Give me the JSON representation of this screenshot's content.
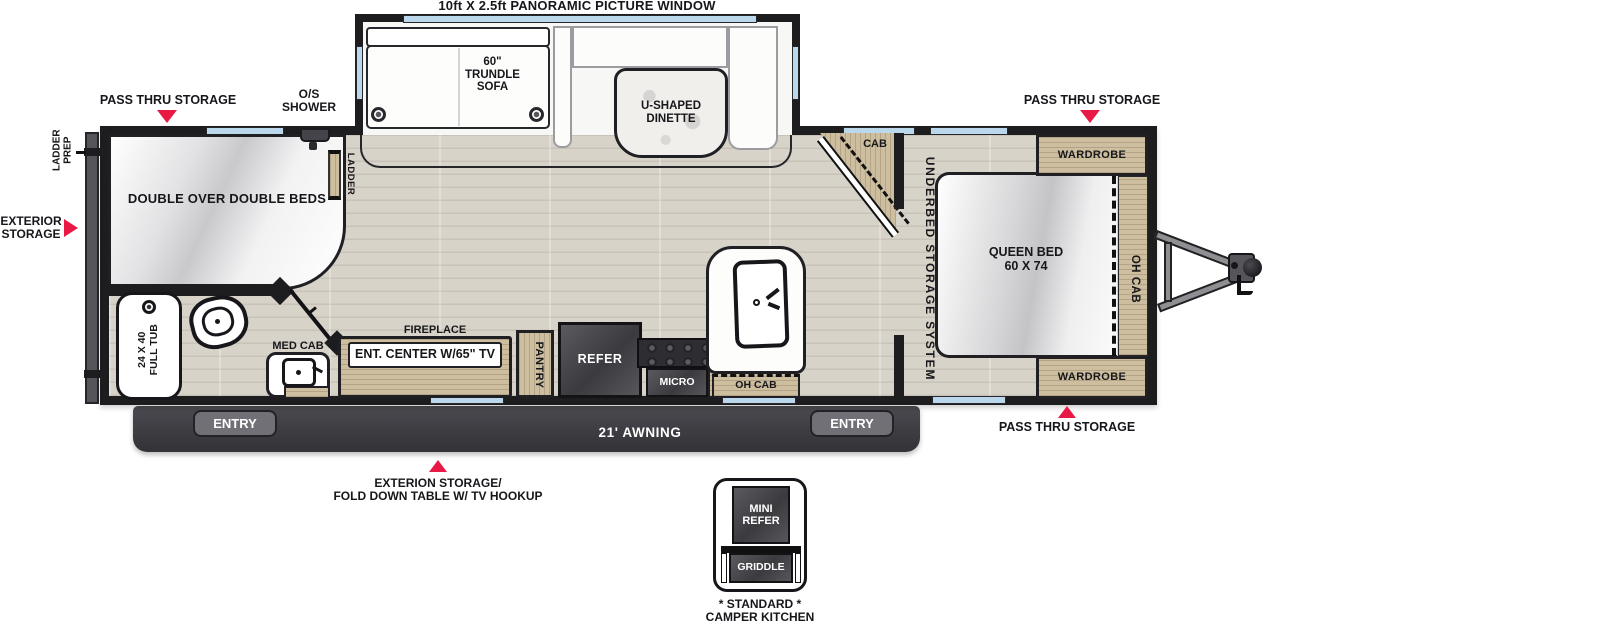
{
  "plan": {
    "title": "10ft X 2.5ft PANORAMIC PICTURE WINDOW",
    "callouts": {
      "pass_thru_top_left": "PASS THRU STORAGE",
      "pass_thru_top_right": "PASS THRU STORAGE",
      "pass_thru_bottom_right": "PASS THRU STORAGE",
      "os_shower": "O/S\nSHOWER",
      "ladder_prep": "LADDER PREP",
      "exterior_storage": "EXTERIOR\nSTORAGE",
      "fold_down_table": "EXTERION STORAGE/\nFOLD DOWN TABLE W/ TV HOOKUP"
    },
    "slideout": {
      "sofa": "60\"\nTRUNDLE\nSOFA",
      "dinette": "U-SHAPED\nDINETTE"
    },
    "bunk_room": {
      "beds": "DOUBLE OVER DOUBLE BEDS",
      "ladder": "LADDER"
    },
    "bathroom": {
      "tub": "24 X 40\nFULL TUB",
      "med_cab": "MED CAB"
    },
    "living": {
      "fireplace": "FIREPLACE",
      "ent_center": "ENT. CENTER W/65\" TV",
      "pantry": "PANTRY",
      "refer": "REFER",
      "micro": "MICRO",
      "oh_cab": "OH CAB",
      "cab": "CAB"
    },
    "bedroom": {
      "underbed": "UNDERBED STORAGE SYSTEM",
      "queen_bed": "QUEEN BED\n60 X 74",
      "oh_cab": "OH CAB",
      "wardrobe_top": "WARDROBE",
      "wardrobe_bottom": "WARDROBE"
    },
    "exterior": {
      "entry_left": "ENTRY",
      "entry_right": "ENTRY",
      "awning": "21' AWNING"
    },
    "camper_kitchen": {
      "mini_refer": "MINI\nREFER",
      "griddle": "GRIDDLE",
      "caption": "* STANDARD *\nCAMPER KITCHEN"
    },
    "colors": {
      "arrow": "#e81a45",
      "window": "#bad7ec",
      "wall": "#1d1d20",
      "wood": "#cdbe9f"
    }
  }
}
